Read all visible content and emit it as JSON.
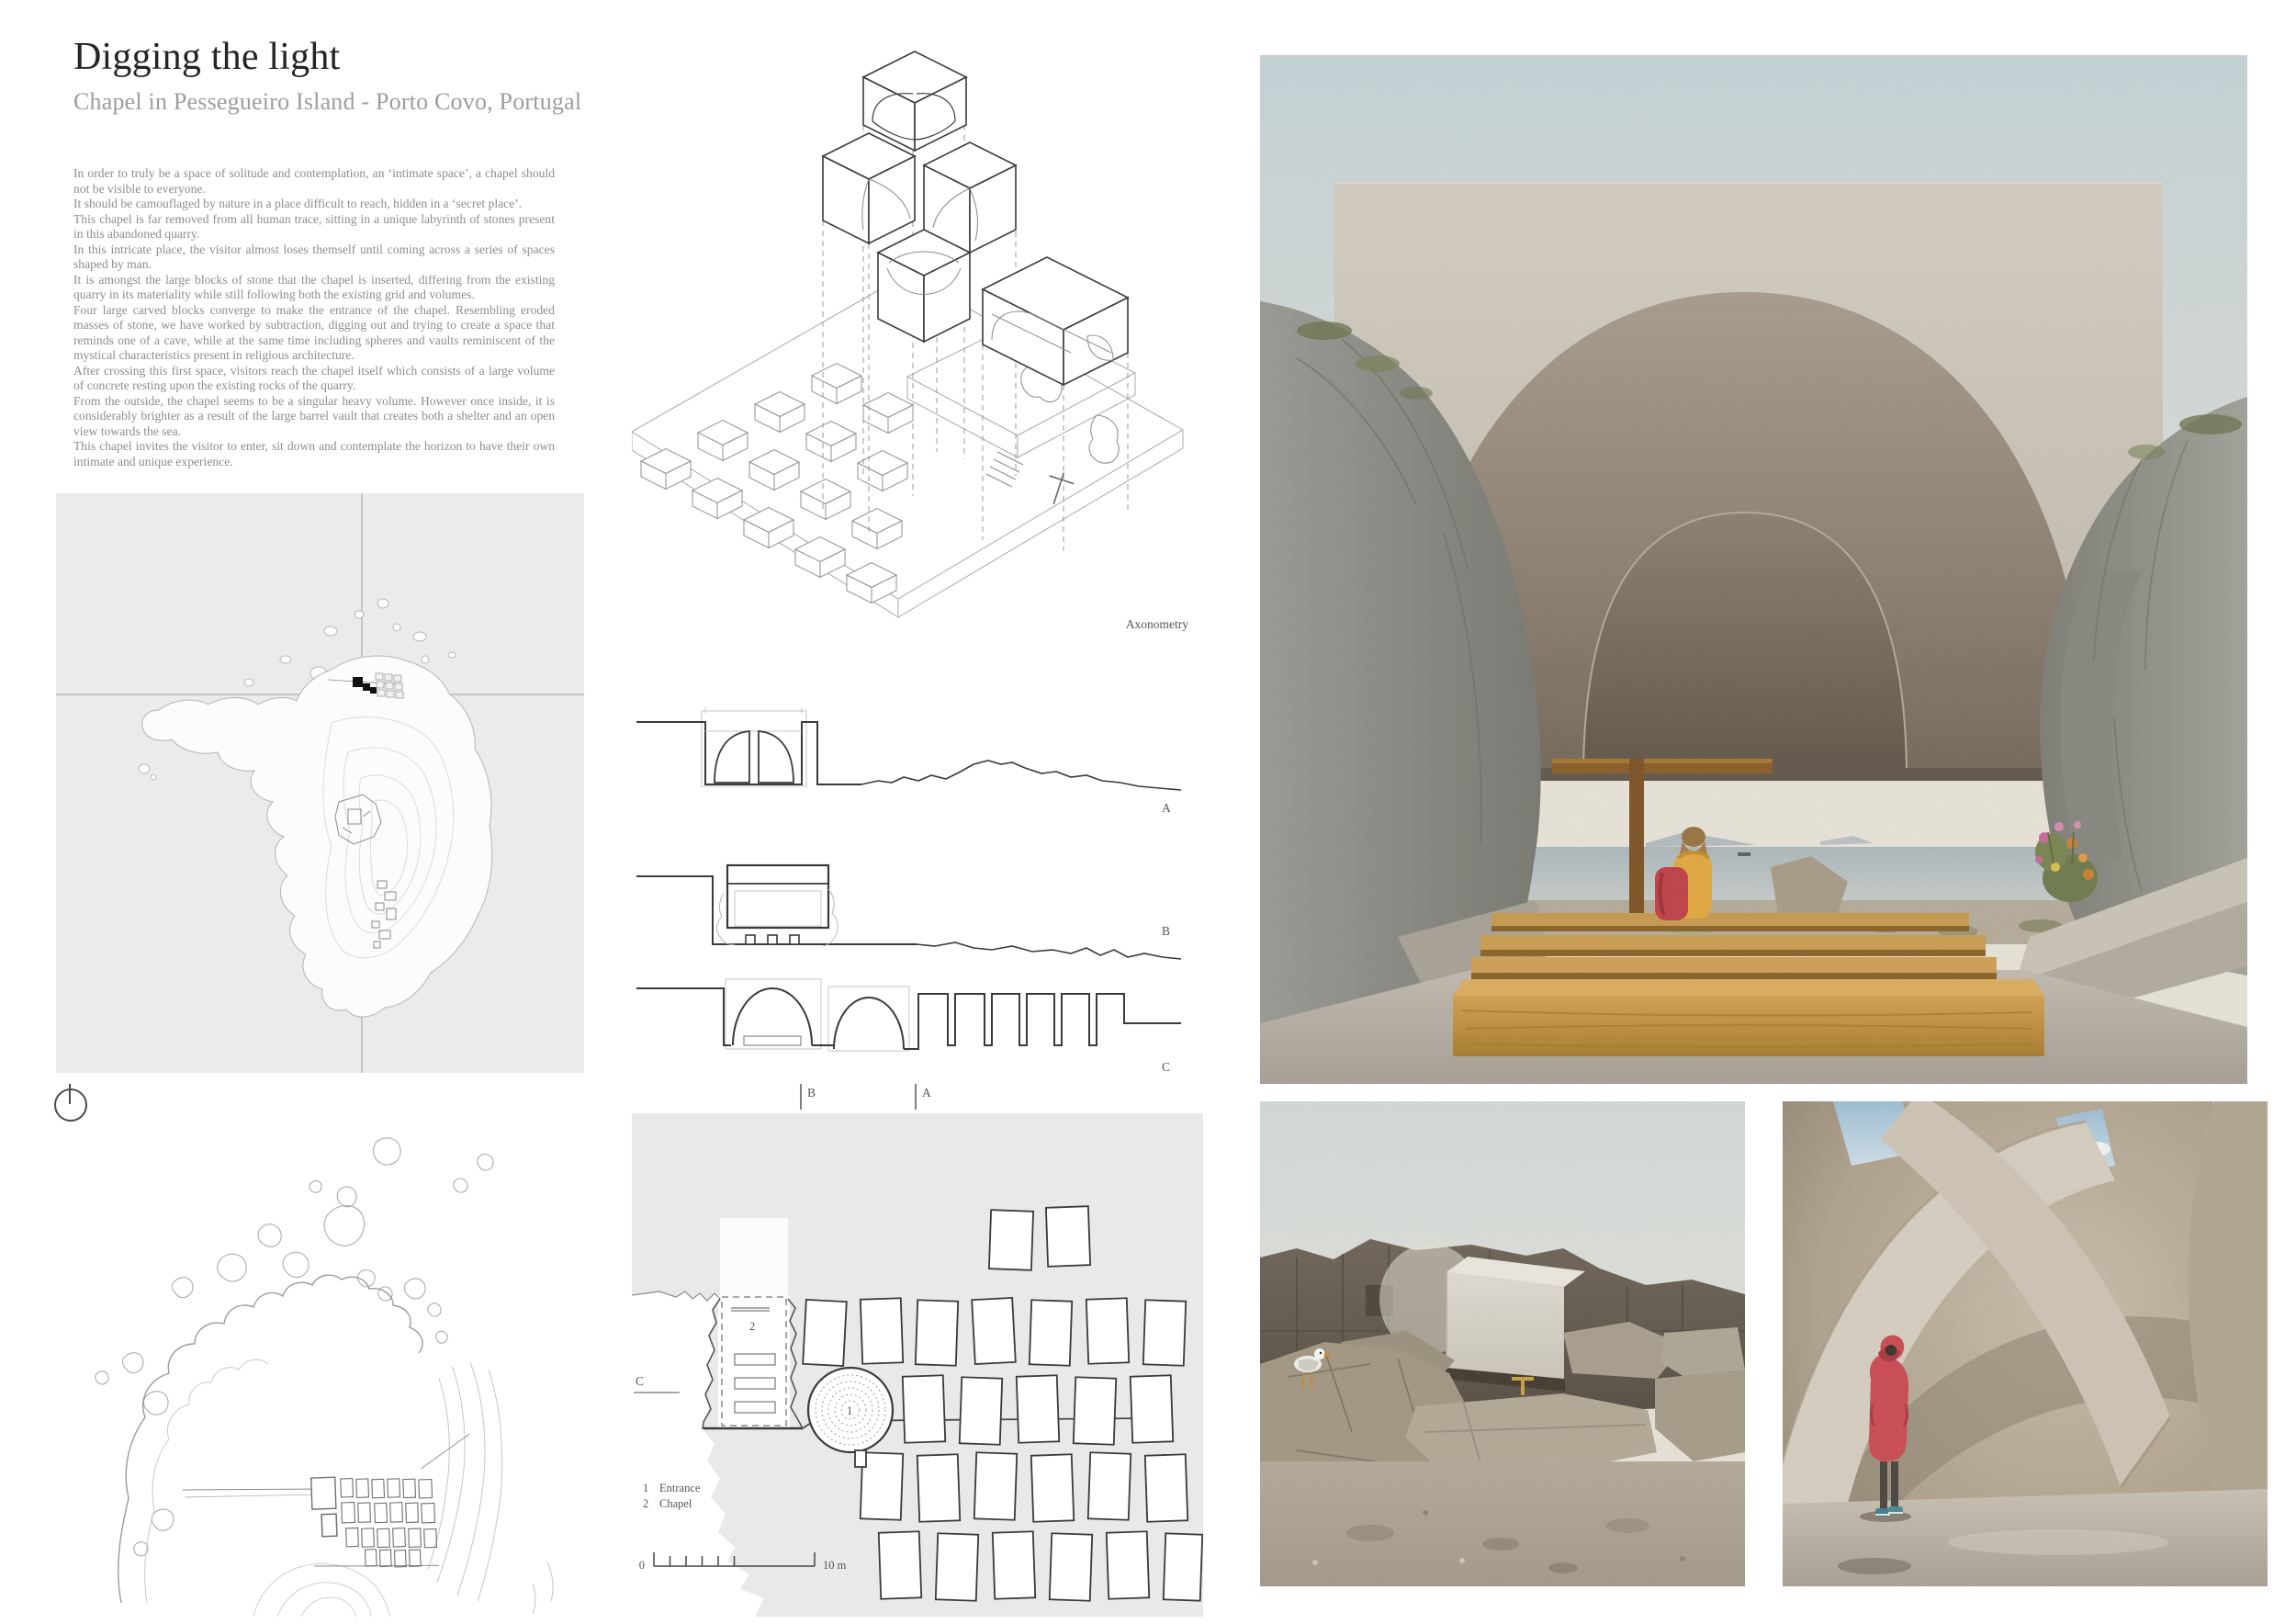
{
  "header": {
    "title": "Digging the light",
    "subtitle": "Chapel in Pessegueiro Island - Porto Covo, Portugal"
  },
  "description": {
    "paragraphs": [
      "In order to truly be a space of solitude and contemplation, an ‘intimate space’, a chapel should not be visible to everyone.",
      "It should be camouflaged by nature in a place difficult to reach, hidden in a ‘secret place’.",
      "This chapel is far removed from all human trace, sitting in a unique labyrinth of stones present in this abandoned quarry.",
      "In this intricate place, the visitor almost loses themself until coming across a series of spaces shaped by man.",
      "It is amongst the large blocks of stone that the chapel is inserted, differing from the existing quarry in its materiality while still following both the existing grid and volumes.",
      "Four large carved blocks converge to make the entrance of the chapel. Resembling eroded masses of stone, we have worked by subtraction, digging out and trying to create a space that reminds one of a cave, while at the same time including spheres and vaults reminiscent of the mystical characteristics present in religious architecture.",
      "After crossing this first space, visitors reach the chapel itself which consists of a large volume of concrete resting upon the existing rocks of the quarry.",
      "From the outside, the chapel seems to be a singular heavy volume. However once inside, it is considerably brighter as a result of the large barrel vault that creates both a shelter and an open view towards the sea.",
      "This chapel invites the visitor to enter, sit down and contemplate the horizon to have their own intimate and unique experience."
    ]
  },
  "drawings": {
    "axonometry": {
      "caption": "Axonometry"
    },
    "sections": {
      "a": "A",
      "b": "B",
      "c": "C"
    },
    "plan": {
      "cut_b": "B",
      "cut_a": "A",
      "cut_c": "C",
      "marker_entrance": "1",
      "marker_chapel": "2",
      "legend": [
        {
          "num": "1",
          "label": "Entrance"
        },
        {
          "num": "2",
          "label": "Chapel"
        }
      ],
      "scale_start": "0",
      "scale_end": "10 m"
    }
  },
  "palette": {
    "page_bg": "#ffffff",
    "map_bg": "#ebebeb",
    "plan_bg": "#e9e9e9",
    "drawing_line_dark": "#3a3a3a",
    "drawing_line_light": "#bdbdbd",
    "title_text": "#242424",
    "body_text": "#8d8d8d",
    "render_sky": "#ccd7da",
    "render_concrete": "#c9c2b7",
    "render_vault": "#7c6f62",
    "render_wood": "#c3923f",
    "render_jacket": "#e2a83e",
    "render_backpack": "#c23f47",
    "render_coat": "#cc4a52",
    "render_rock": "#92928c"
  }
}
